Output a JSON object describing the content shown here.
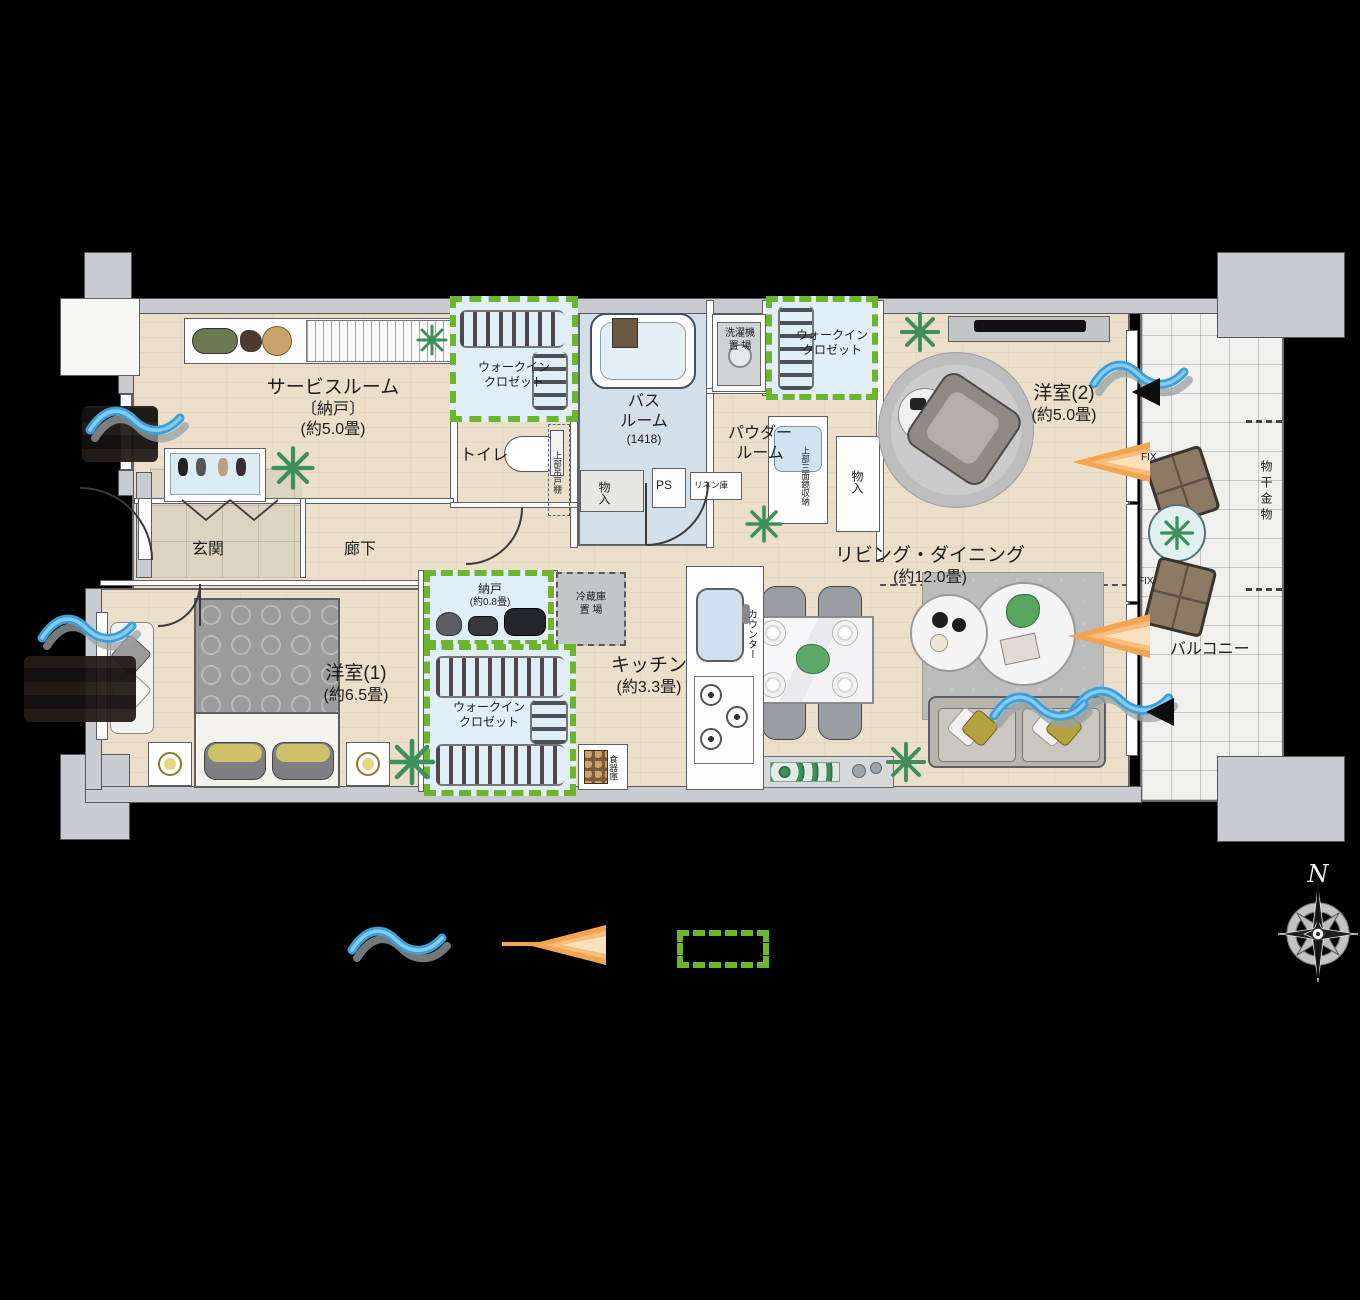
{
  "rooms": {
    "service": {
      "name": "サービスルーム",
      "sub": "〔納戸〕",
      "size": "(約5.0畳)"
    },
    "wic": "ウォークイン\nクロゼット",
    "toilet": "トイレ",
    "bath": {
      "l1": "バス",
      "l2": "ルーム",
      "size": "(1418)"
    },
    "washer": {
      "l1": "洗濯機",
      "l2": "置 場"
    },
    "powder": {
      "l1": "パウダー",
      "l2": "ルーム"
    },
    "west2": {
      "name": "洋室(2)",
      "size": "(約5.0畳)"
    },
    "living": {
      "name": "リビング・ダイニング",
      "size": "(約12.0畳)"
    },
    "kitchen": {
      "name": "キッチン",
      "size": "(約3.3畳)"
    },
    "nando": {
      "name": "納戸",
      "size": "(約0.8畳)"
    },
    "west1": {
      "name": "洋室(1)",
      "size": "(約6.5畳)"
    },
    "genkan": "玄関",
    "hall": "廊下",
    "balcony": "バルコニー"
  },
  "fixtures": {
    "fridge": "冷蔵庫\n置 場",
    "storage": "物入",
    "ps": "PS",
    "linen": "リネン庫",
    "upper_cabinet": "上部吊戸棚",
    "mirror_cabinet": "上部三面鏡収納",
    "counter": "カウンター",
    "dish_cabinet": "食器庫",
    "drying_fitting": "物干金物",
    "fix_window": "FIX"
  },
  "compass": {
    "north": "N"
  },
  "legend": {
    "breeze_icon": "blue-wave",
    "sunlight_icon": "orange-beam",
    "closet_icon": "green-dashed-box",
    "breeze_color": "#3ea2dc",
    "sunlight_color": "#f2a44f",
    "closet_color": "#6cb52d"
  }
}
